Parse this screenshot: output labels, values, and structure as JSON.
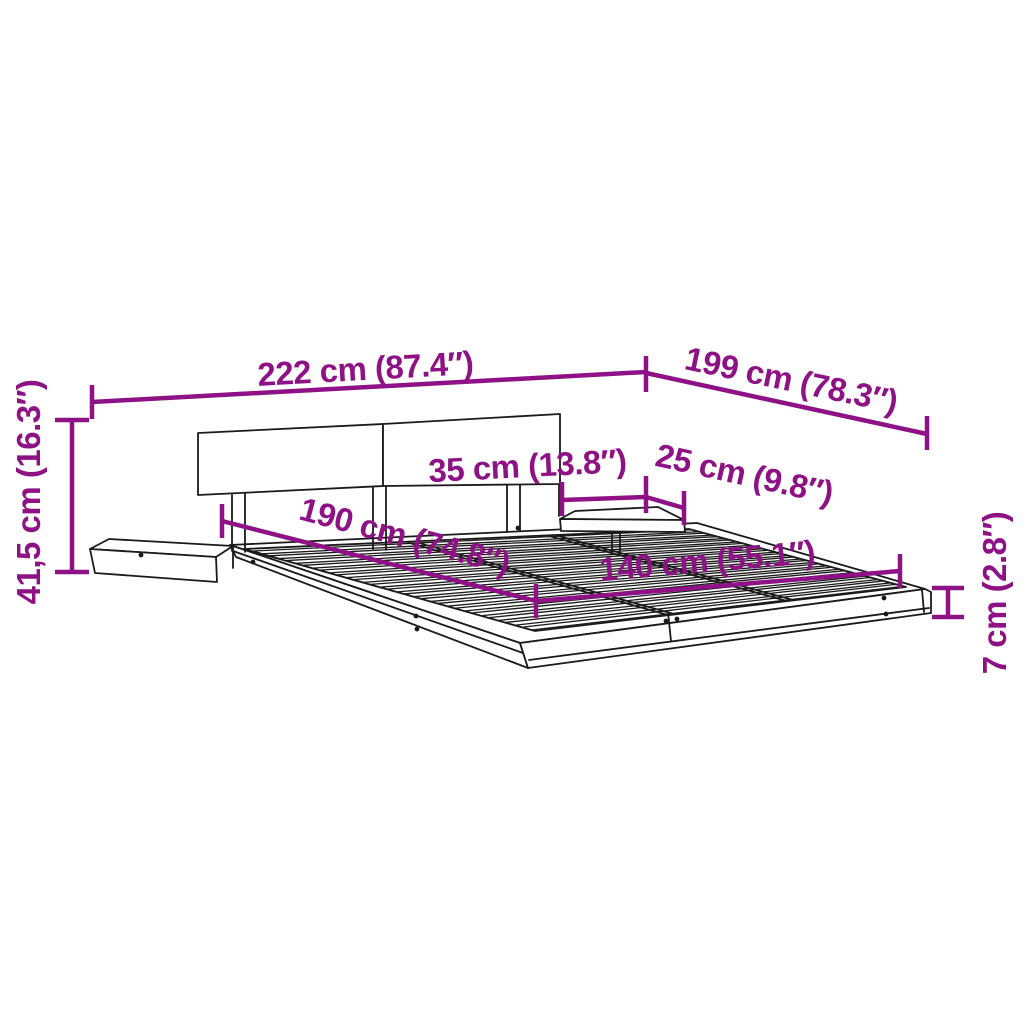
{
  "figure": {
    "kind": "product dimension diagram",
    "product": "platform bed frame with headboard and floating bedside shelves",
    "background_color": "#ffffff",
    "drawing_color": "#1a1a1a",
    "dimension_color": "#8E1285"
  },
  "dimensions": {
    "total_width": {
      "label": "222 cm (87.4″)"
    },
    "total_depth": {
      "label": "199 cm (78.3″)"
    },
    "headboard_height": {
      "label": "41,5 cm (16.3″)"
    },
    "shelf_width": {
      "label": "35 cm (13.8″)"
    },
    "shelf_depth": {
      "label": "25 cm (9.8″)"
    },
    "sleep_length": {
      "label": "190 cm (74.8″)"
    },
    "sleep_width": {
      "label": "140 cm (55.1″)"
    },
    "frame_height": {
      "label": "7 cm (2.8″)"
    }
  }
}
